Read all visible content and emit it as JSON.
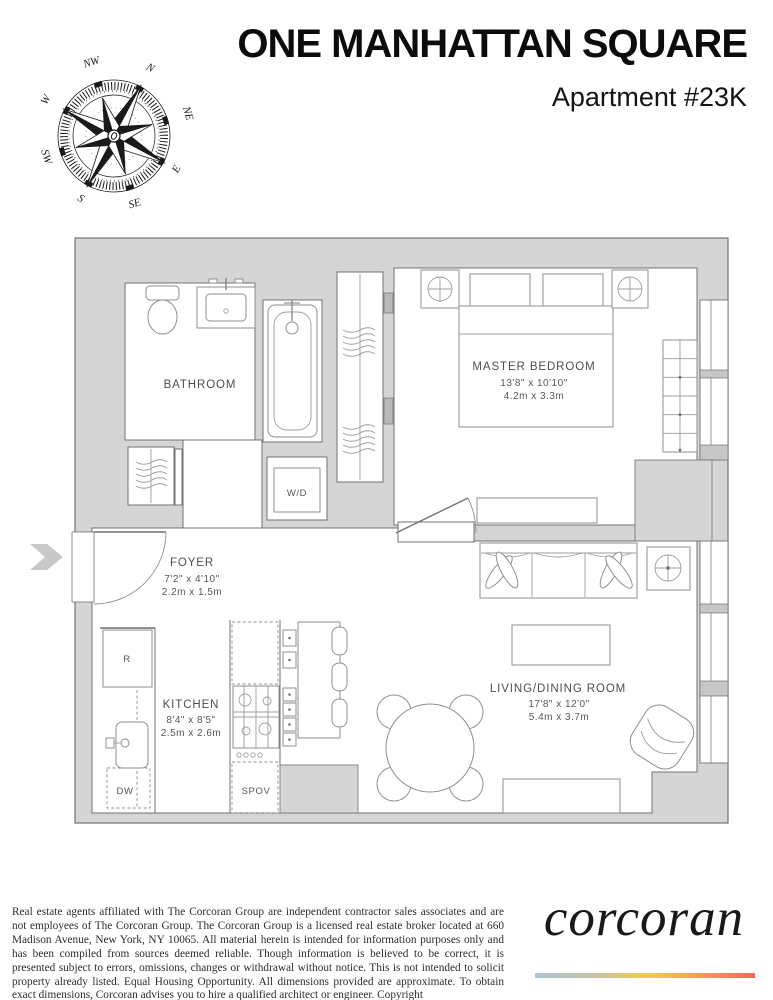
{
  "header": {
    "building_name": "ONE MANHATTAN SQUARE",
    "apartment": "Apartment #23K"
  },
  "compass": {
    "directions": {
      "n": "N",
      "ne": "NE",
      "e": "E",
      "se": "SE",
      "s": "S",
      "sw": "SW",
      "w": "W",
      "nw": "NW"
    }
  },
  "floorplan": {
    "rooms": {
      "bathroom": {
        "name": "BATHROOM"
      },
      "foyer": {
        "name": "FOYER",
        "imperial": "7'2\" x 4'10\"",
        "metric": "2.2m x 1.5m"
      },
      "kitchen": {
        "name": "KITCHEN",
        "imperial": "8'4\" x 8'5\"",
        "metric": "2.5m x 2.6m"
      },
      "master_bedroom": {
        "name": "MASTER BEDROOM",
        "imperial": "13'8\" x 10'10\"",
        "metric": "4.2m x 3.3m"
      },
      "living_dining": {
        "name": "LIVING/DINING ROOM",
        "imperial": "17'8\" x 12'0\"",
        "metric": "5.4m x 3.7m"
      }
    },
    "appliances": {
      "washer_dryer": "W/D",
      "refrigerator": "R",
      "dishwasher": "DW",
      "speed_oven": "SPOV"
    }
  },
  "footer": {
    "disclaimer": "Real estate agents affiliated with The Corcoran Group are independent contractor sales associates and are not employees of The Corcoran Group. The Corcoran Group is a licensed real estate broker located at 660 Madison Avenue, New York, NY 10065. All material herein is intended for information purposes only and has been compiled from sources deemed reliable. Though information is believed to be correct, it is presented subject to errors, omissions, changes or withdrawal without notice. This is not intended to solicit property already listed. Equal Housing Opportunity. All dimensions provided are approximate. To obtain exact dimensions, Corcoran advises you to hire a qualified architect or engineer. Copyright",
    "brand": "corcoran"
  },
  "colors": {
    "plan_background": "#d5d5d6",
    "wall_line": "#6f7276",
    "brand_gradient": [
      "#aec4d2",
      "#f2cb4e",
      "#ee6a62"
    ]
  }
}
